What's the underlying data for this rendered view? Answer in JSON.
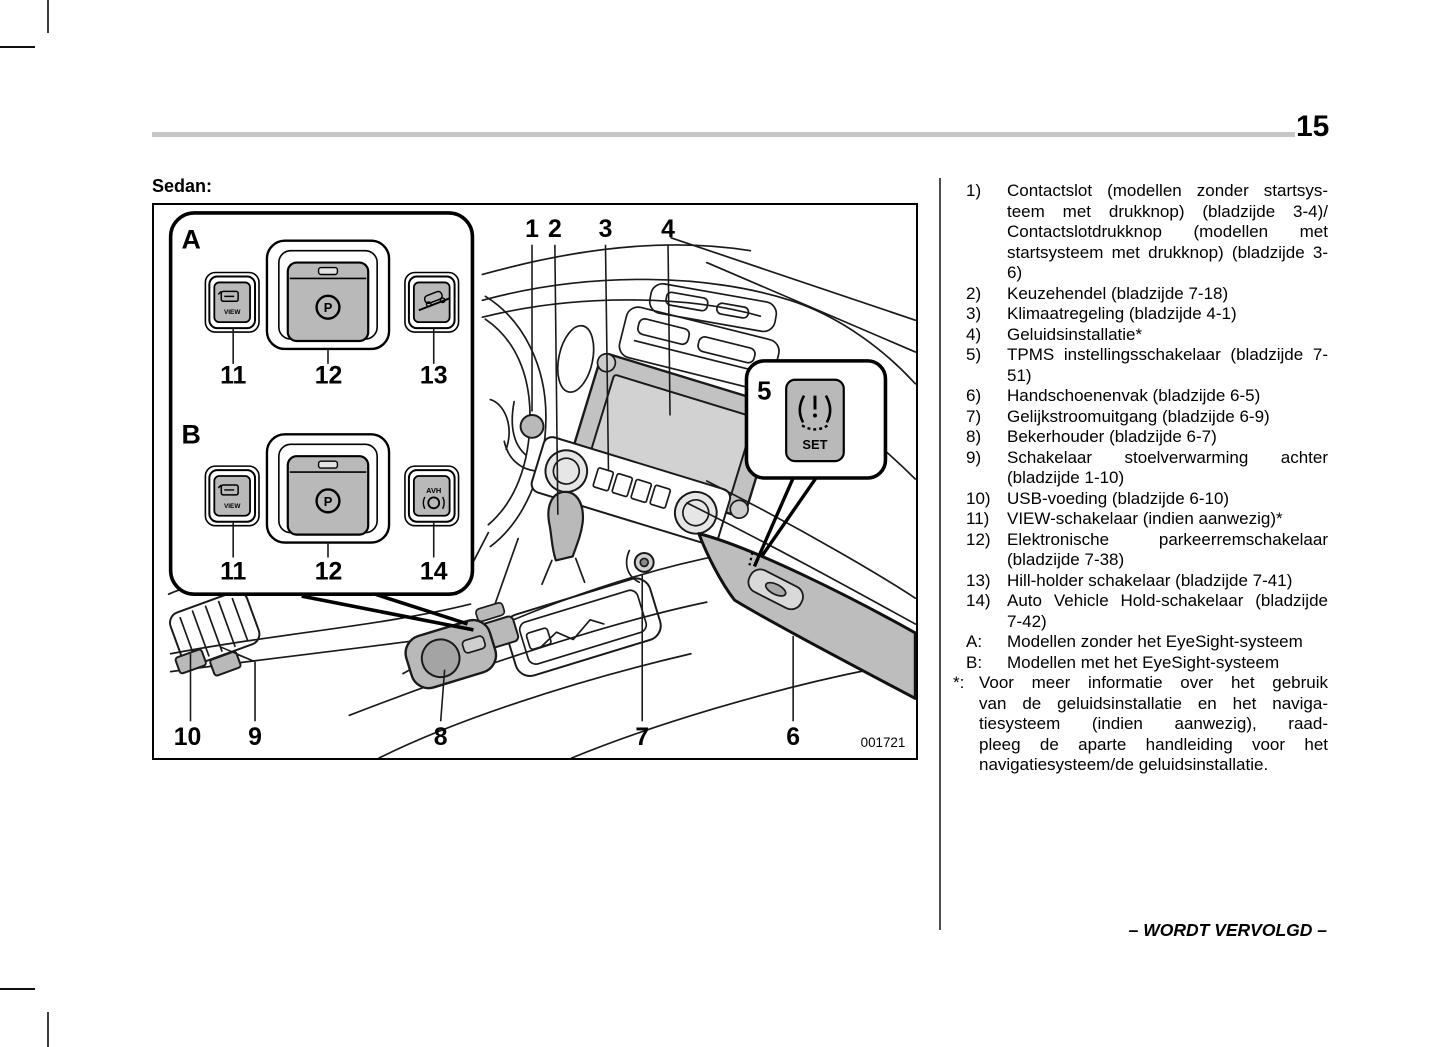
{
  "page": {
    "number": "15",
    "section_label": "Sedan:",
    "continuation": "– WORDT VERVOLGD –",
    "figure_code": "001721"
  },
  "legend": {
    "items": [
      {
        "marker": "1)",
        "lines": [
          "Contactslot (modellen zonder startsys-",
          "teem met drukknop) (bladzijde 3-4)/",
          "Contactslotdrukknop (modellen met",
          "startsysteem met drukknop) (bladzijde 3-",
          "6)"
        ]
      },
      {
        "marker": "2)",
        "lines": [
          "Keuzehendel (bladzijde 7-18)"
        ]
      },
      {
        "marker": "3)",
        "lines": [
          "Klimaatregeling (bladzijde 4-1)"
        ]
      },
      {
        "marker": "4)",
        "lines": [
          "Geluidsinstallatie*"
        ]
      },
      {
        "marker": "5)",
        "lines": [
          "TPMS instellingsschakelaar (bladzijde 7-",
          "51)"
        ]
      },
      {
        "marker": "6)",
        "lines": [
          "Handschoenenvak (bladzijde 6-5)"
        ]
      },
      {
        "marker": "7)",
        "lines": [
          "Gelijkstroomuitgang (bladzijde 6-9)"
        ]
      },
      {
        "marker": "8)",
        "lines": [
          "Bekerhouder (bladzijde 6-7)"
        ]
      },
      {
        "marker": "9)",
        "lines": [
          "Schakelaar stoelverwarming achter",
          "(bladzijde 1-10)"
        ]
      },
      {
        "marker": "10)",
        "lines": [
          "USB-voeding (bladzijde 6-10)"
        ]
      },
      {
        "marker": "11)",
        "lines": [
          "VIEW-schakelaar (indien aanwezig)*"
        ]
      },
      {
        "marker": "12)",
        "lines": [
          "Elektronische parkeerremschakelaar",
          "(bladzijde 7-38)"
        ]
      },
      {
        "marker": "13)",
        "lines": [
          "Hill-holder schakelaar (bladzijde 7-41)"
        ]
      },
      {
        "marker": "14)",
        "lines": [
          "Auto Vehicle Hold-schakelaar (bladzijde",
          "7-42)"
        ]
      },
      {
        "marker": "A:",
        "lines": [
          "Modellen zonder het EyeSight-systeem"
        ]
      },
      {
        "marker": "B:",
        "lines": [
          "Modellen met het EyeSight-systeem"
        ]
      },
      {
        "marker": "*:",
        "note": true,
        "lines": [
          "Voor meer informatie over het gebruik",
          "van de geluidsinstallatie en het naviga-",
          "tiesysteem (indien aanwezig), raad-",
          "pleeg de aparte handleiding voor het",
          "navigatiesysteem/de geluidsinstallatie."
        ]
      }
    ]
  },
  "diagram": {
    "top_numbers": [
      "1",
      "2",
      "3",
      "4"
    ],
    "bottom_numbers": [
      "10",
      "9",
      "8",
      "7",
      "6"
    ],
    "inset": {
      "row_a_label": "A",
      "row_b_label": "B",
      "labels_a": [
        "11",
        "12",
        "13"
      ],
      "labels_b": [
        "11",
        "12",
        "14"
      ],
      "view_label": "VIEW",
      "p_label": "P",
      "avh_label": "AVH"
    },
    "callout5": {
      "number": "5",
      "set_label": "SET"
    }
  },
  "colors": {
    "header_rule_gray": "#c6c6c6",
    "diagram_fill_gray": "#b9b9b9",
    "screen_gray": "#d2d2d2"
  }
}
